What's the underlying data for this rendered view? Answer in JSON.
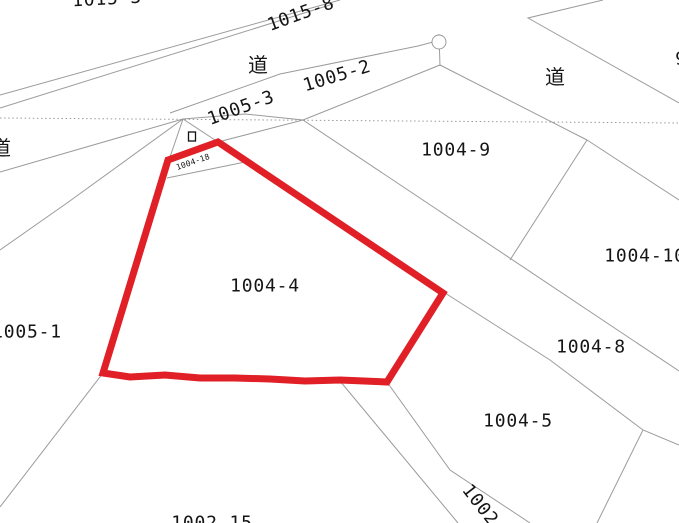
{
  "map": {
    "highlighted_parcel": "1004-4",
    "colors": {
      "highlight_red": "#e01f26",
      "boundary_gray": "#9b9b9b",
      "text_black": "#151515",
      "background": "#ffffff"
    },
    "labels": {
      "parcel_1015_3": "1015-3",
      "parcel_1015_8": "1015-8",
      "road_top": "道",
      "parcel_1005_3": "1005-3",
      "parcel_1005_2": "1005-2",
      "road_right": "道",
      "road_left": "道",
      "parcel_edge_9": "9",
      "parcel_1004_9": "1004-9",
      "parcel_1004_10": "1004-10",
      "parcel_1004_8": "1004-8",
      "parcel_1004_5": "1004-5",
      "parcel_1004_4": "1004-4",
      "parcel_1004_18": "1004-18",
      "parcel_1005_1": "1005-1",
      "parcel_1002_15": "1002-15",
      "parcel_1002": "1002"
    }
  }
}
